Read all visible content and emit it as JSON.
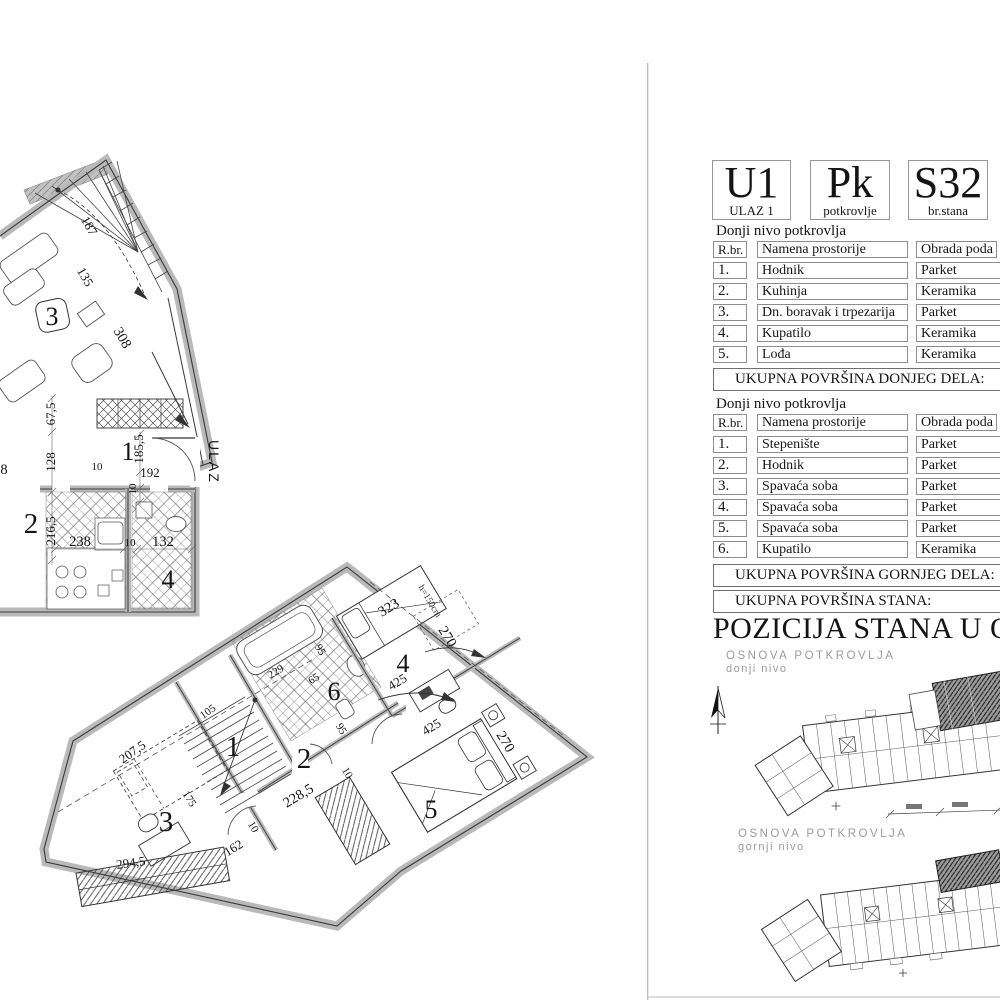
{
  "header": {
    "entrance": {
      "code": "U1",
      "label": "ULAZ 1"
    },
    "level": {
      "code": "Pk",
      "label": "potkrovlje"
    },
    "apartment": {
      "code": "S32",
      "label": "br.stana"
    }
  },
  "tables": {
    "columns": {
      "num": "R.br.",
      "room": "Namena prostorije",
      "floor": "Obrada poda"
    },
    "lower": {
      "caption": "Donji nivo potkrovlja",
      "rows": [
        {
          "num": "1.",
          "room": "Hodnik",
          "floor": "Parket"
        },
        {
          "num": "2.",
          "room": "Kuhinja",
          "floor": "Keramika"
        },
        {
          "num": "3.",
          "room": "Dn. boravak i trpezarija",
          "floor": "Parket"
        },
        {
          "num": "4.",
          "room": "Kupatilo",
          "floor": "Keramika"
        },
        {
          "num": "5.",
          "room": "Lođa",
          "floor": "Keramika"
        }
      ],
      "total_label": "UKUPNA POVRŠINA DONJEG DELA:"
    },
    "upper": {
      "caption": "Donji nivo potkrovlja",
      "rows": [
        {
          "num": "1.",
          "room": "Stepenište",
          "floor": "Parket"
        },
        {
          "num": "2.",
          "room": "Hodnik",
          "floor": "Parket"
        },
        {
          "num": "3.",
          "room": "Spavaća soba",
          "floor": "Parket"
        },
        {
          "num": "4.",
          "room": "Spavaća soba",
          "floor": "Parket"
        },
        {
          "num": "5.",
          "room": "Spavaća soba",
          "floor": "Parket"
        },
        {
          "num": "6.",
          "room": "Kupatilo",
          "floor": "Keramika"
        }
      ],
      "total_label": "UKUPNA POVRŠINA GORNJEG DELA:"
    },
    "apartment_total_label": "UKUPNA POVRŠINA STANA:"
  },
  "position": {
    "title": "POZICIJA STANA U O",
    "plans": [
      {
        "title": "OSNOVA POTKROVLJA",
        "subtitle": "donji nivo"
      },
      {
        "title": "OSNOVA POTKROVLJA",
        "subtitle": "gornji nivo"
      }
    ]
  },
  "plan_entrance_level": {
    "entrance_label": "ULAZ",
    "rooms": {
      "r1": "1",
      "r2": "2",
      "r3": "3",
      "r4": "4"
    },
    "dims": {
      "d308": "308",
      "d675": "67,5",
      "d128": "128",
      "d10a": "10",
      "d1855": "185,5",
      "d192": "192",
      "d10b": "10",
      "d2165": "216,5",
      "d238": "238",
      "d10c": "10",
      "d132": "132",
      "d8": "8",
      "d135": "135",
      "d187": "187"
    }
  },
  "plan_top_level": {
    "rooms": {
      "r1": "1",
      "r2": "2",
      "r3": "3",
      "r4": "4",
      "r5": "5",
      "r6": "6"
    },
    "dims": {
      "d323": "323",
      "d270a": "270",
      "d425a": "425",
      "d425b": "425",
      "d270b": "270",
      "d95a": "95",
      "d95b": "95",
      "d65": "65",
      "d229": "229",
      "d2285": "228,5",
      "d2075": "207,5",
      "d105": "105",
      "d175": "175",
      "d2945": "294,5",
      "d162": "162",
      "d10a": "10",
      "d10b": "10",
      "height_note": "h=150cm"
    }
  }
}
